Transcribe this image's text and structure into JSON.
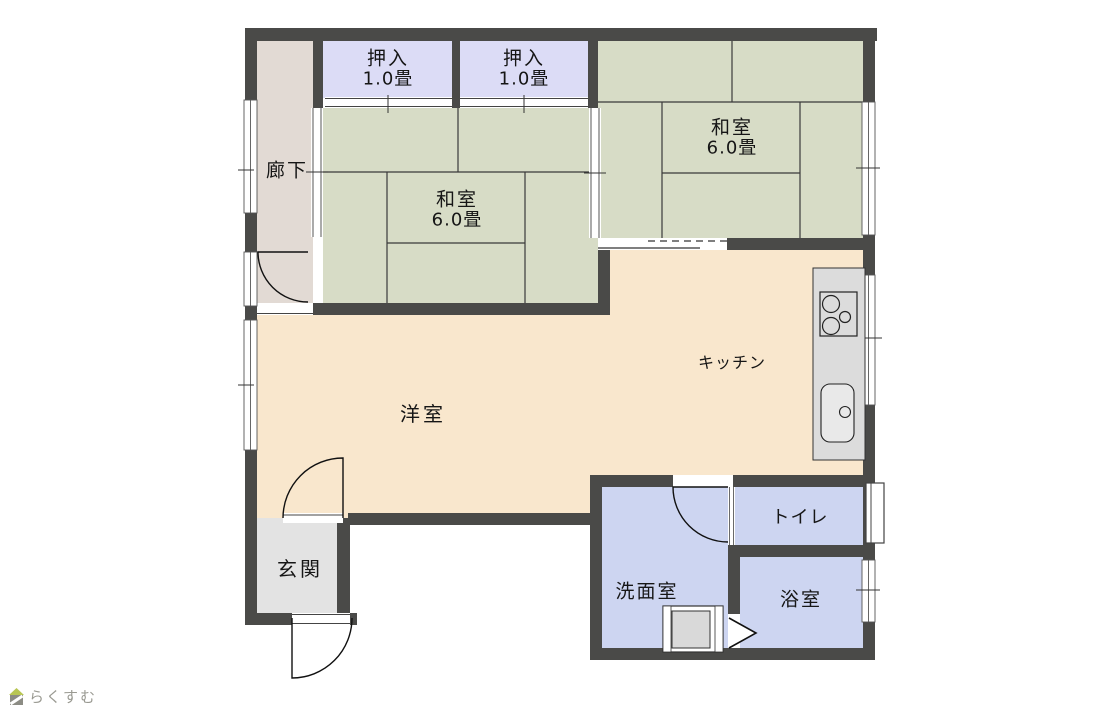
{
  "floorplan": {
    "rooms": {
      "hallway": {
        "label": "廊下"
      },
      "closet_1": {
        "label": "押入",
        "size": "1.0畳"
      },
      "closet_2": {
        "label": "押入",
        "size": "1.0畳"
      },
      "washitsu_left": {
        "label": "和室",
        "size": "6.0畳"
      },
      "washitsu_right": {
        "label": "和室",
        "size": "6.0畳"
      },
      "western_room": {
        "label": "洋室"
      },
      "kitchen": {
        "label": "キッチン"
      },
      "entrance": {
        "label": "玄関"
      },
      "washroom": {
        "label": "洗面室"
      },
      "toilet": {
        "label": "トイレ"
      },
      "bathroom": {
        "label": "浴室"
      }
    },
    "fixtures": {
      "stove": "stove-icon",
      "sink": "sink-icon",
      "washing_machine": "washing-machine-icon",
      "folding_door": "folding-door-zigzag",
      "doors": "hinged-door-arc"
    },
    "colors": {
      "wall": "#4a4a48",
      "tatami": "#d7dcc6",
      "closet": "#dcdcf6",
      "hallway": "#e2dad4",
      "flooring": "#f9e7cd",
      "entrance": "#e3e3e3",
      "wet_room": "#cdd5f1",
      "counter": "#dcdcdc",
      "outline": "#3a3a3a"
    }
  },
  "branding": {
    "logo_text": "らくすむ",
    "logo_icon": "house-icon",
    "logo_green": "#b8c653",
    "logo_gray": "#8c8c84"
  }
}
